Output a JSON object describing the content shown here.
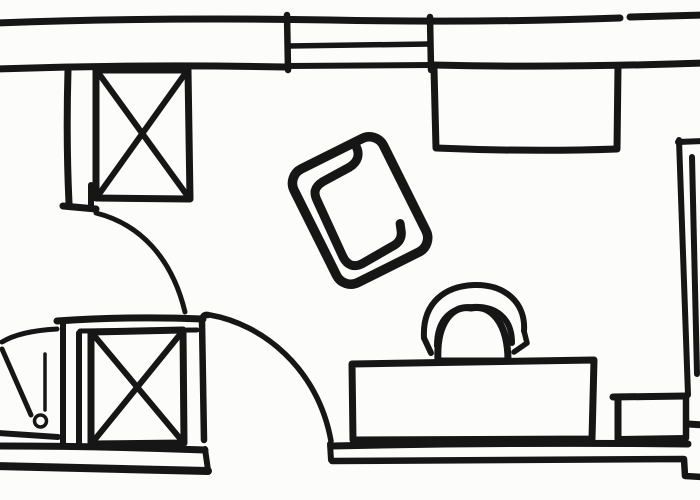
{
  "canvas": {
    "width_px": 700,
    "height_px": 500,
    "paper_color": "#fcfcfa",
    "ink_color": "#161616"
  },
  "sketch": {
    "kind": "hand-drawn floor plan",
    "elements": [
      {
        "id": "top-wall",
        "label": "top exterior wall, double line with small gap"
      },
      {
        "id": "window",
        "label": "window symbol with jambs and sill lines"
      },
      {
        "id": "entry-pier",
        "label": "interior wall stub below top wall"
      },
      {
        "id": "wardrobe-top",
        "label": "crossed-box symbol (wardrobe/shaft), upper left"
      },
      {
        "id": "hall-door-arc",
        "label": "door swing arc, upper left opening"
      },
      {
        "id": "bathroom",
        "label": "small room with door lines and knob, lower left"
      },
      {
        "id": "wardrobe-bottom",
        "label": "crossed-box symbol (wardrobe/shaft), lower left"
      },
      {
        "id": "bottom-door",
        "label": "door leaf with swing arc, bottom center"
      },
      {
        "id": "bottom-wall",
        "label": "bottom exterior wall, double line with opening"
      },
      {
        "id": "armchair",
        "label": "tilted armchair with inner seat line, center"
      },
      {
        "id": "cabinet",
        "label": "rectangle against top wall (cabinet/bed), upper right"
      },
      {
        "id": "desk",
        "label": "desk rectangle on bottom wall, lower right"
      },
      {
        "id": "desk-chair",
        "label": "chair with arched back at desk"
      },
      {
        "id": "side-table",
        "label": "small rectangle beside desk, lower right"
      },
      {
        "id": "right-wall",
        "label": "wall fragment along right edge"
      }
    ]
  }
}
